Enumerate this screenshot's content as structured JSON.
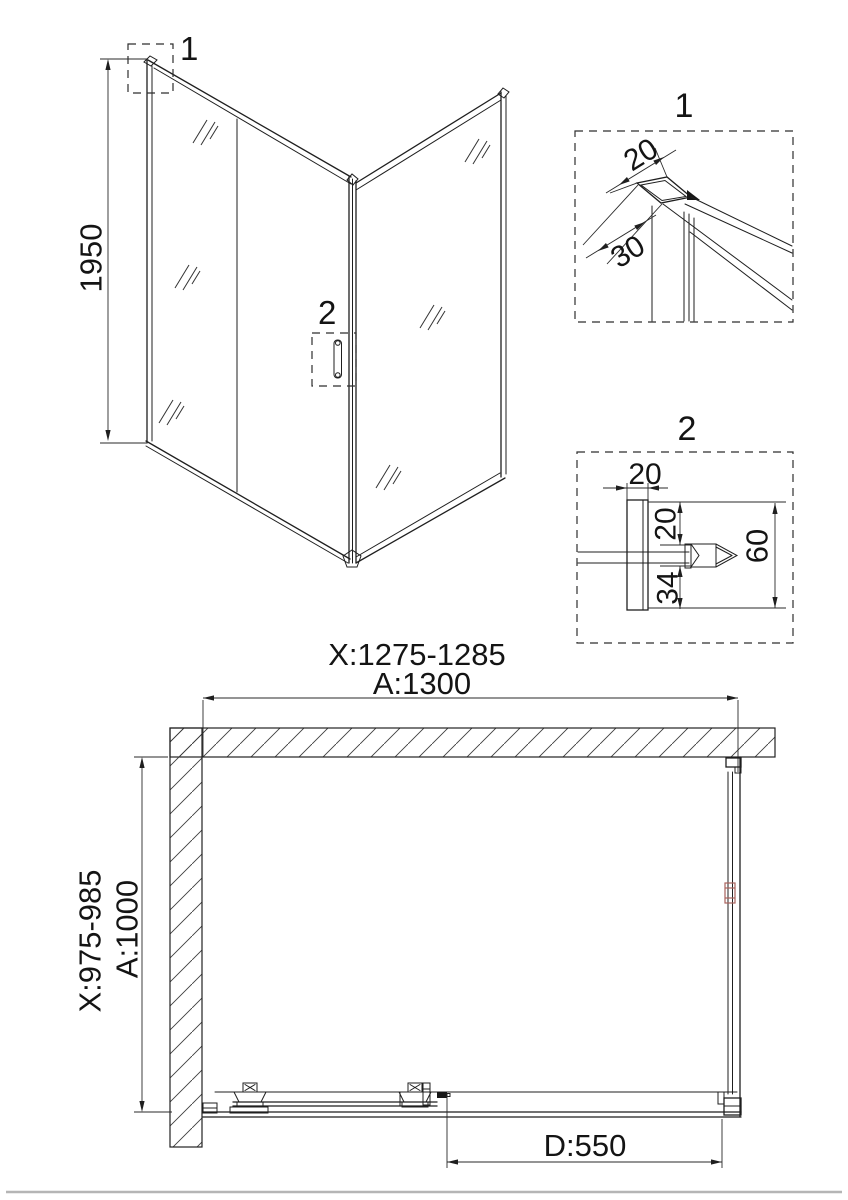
{
  "perspective": {
    "height_dim": "1950",
    "marker_1": "1",
    "marker_2": "2"
  },
  "detail_1": {
    "title": "1",
    "dim_width": "20",
    "dim_depth": "30"
  },
  "detail_2": {
    "title": "2",
    "dim_profile_width": "20",
    "dim_gap_top": "20",
    "dim_gap_bottom": "34",
    "dim_total_height": "60"
  },
  "plan": {
    "width_range": "X:1275-1285",
    "width_total": "A:1300",
    "depth_range": "X:975-985",
    "depth_total": "A:1000",
    "door_width": "D:550"
  },
  "colors": {
    "line": "#1f1f1f",
    "accent_red": "#a8625c",
    "footer_gray": "#b5b5b5"
  }
}
